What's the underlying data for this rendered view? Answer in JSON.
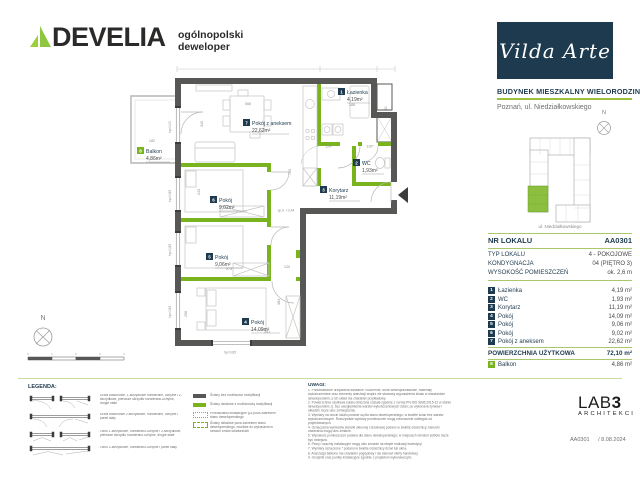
{
  "header": {
    "brand": "DEVELIA",
    "tagline_line1": "ogólnopolski",
    "tagline_line2": "deweloper",
    "project_name": "Vilda Arte",
    "building_type": "BUDYNEK MIESZKALNY WIELORODZINNY",
    "address": "Poznań, ul. Niedziałkowskiego",
    "north_label": "N"
  },
  "site_plan": {
    "street_caption": "ul. Niedziałkowskiego"
  },
  "unit": {
    "number_label": "NR LOKALU",
    "number": "AA0301",
    "type_label": "TYP LOKALU",
    "type": "4 - POKOJOWE",
    "floor_label": "KONDYGNACJA",
    "floor": "04 (PIĘTRO 3)",
    "height_label": "WYSOKOŚĆ POMIESZCZEŃ",
    "height": "ok. 2,6 m",
    "rooms": [
      {
        "num": "1",
        "name": "Łazienka",
        "area": "4,19 m²"
      },
      {
        "num": "2",
        "name": "WC",
        "area": "1,93 m²"
      },
      {
        "num": "3",
        "name": "Korytarz",
        "area": "11,19 m²"
      },
      {
        "num": "4",
        "name": "Pokój",
        "area": "14,09 m²"
      },
      {
        "num": "5",
        "name": "Pokój",
        "area": "9,06 m²"
      },
      {
        "num": "6",
        "name": "Pokój",
        "area": "9,02 m²"
      },
      {
        "num": "7",
        "name": "Pokój z aneksem",
        "area": "22,62 m²"
      }
    ],
    "total_label": "POWIERZCHNIA UŻYTKOWA",
    "total": "72,10 m²",
    "balcony": {
      "num": "8",
      "name": "Balkon",
      "area": "4,86 m²"
    }
  },
  "plan": {
    "labels": [
      {
        "num": "1",
        "name": "Łazienka",
        "area": "4,19m²"
      },
      {
        "num": "2",
        "name": "WC",
        "area": "1,93m²"
      },
      {
        "num": "3",
        "name": "Korytarz",
        "area": "11,19m²"
      },
      {
        "num": "4",
        "name": "Pokój",
        "area": "14,09m²"
      },
      {
        "num": "5",
        "name": "Pokój",
        "area": "9,06m²"
      },
      {
        "num": "6",
        "name": "Pokój",
        "area": "9,02m²"
      },
      {
        "num": "7",
        "name": "Pokój z aneksem",
        "area": "22,62m²"
      },
      {
        "num": "8",
        "name": "Balkon",
        "area": "4,86m²"
      }
    ],
    "dims": [
      "566",
      "340",
      "182",
      "188",
      "124*",
      "110*",
      "763",
      "243",
      "373",
      "120",
      "256",
      "383",
      "391",
      "sp.b. +2,44",
      "hp=0,00",
      "hp=0,85",
      "hp=0,85",
      "hp=0,85",
      "hp=0,85",
      "60"
    ],
    "scale_ticks": [
      "0",
      "1",
      "2",
      "3",
      "4"
    ],
    "north_label": "N"
  },
  "legend": {
    "title": "LEGENDA:",
    "windows": [
      "Drzwi balkonowe, 1-skrzydłowe rozwierane, uchylne i 2-skrzydłowe, pierwsze skrzydło rozwierano-uchylne, drugie stałe",
      "Drzwi balkonowe 2-skrzydłowe, rozwierane, uchylne i panel stały",
      "Okno 1-skrzydłowe, rozwierano-uchylne i 2-skrzydłowe, pierwsze skrzydło rozwierano-uchylne, drugie stałe",
      "Okno 2-skrzydłowe, rozwierano-uchylne i panel stały"
    ],
    "walls": [
      "Ściany bez możliwości modyfikacji",
      "Ściany działowe z możliwością modyfikacji",
      "Przedścianki instalacyjne g-k poza zakresem stanu deweloperskiego",
      "Ściany działowe poza zakresem stanu deweloperskiego, możliwe do wykonania w ramach zmian lokatorskich"
    ]
  },
  "uwagi": {
    "title": "UWAGI:",
    "notes": [
      "1. Przedstawione urządzenia sanitarne i kuchenne, drzwi wewnątrzlokalowe, materiały wykończeniowe oraz elementy aranżacji wnętrz nie stanowią wyposażenia lokalu w standardzie deweloperskim, a ich układ ma charakter przykładowy.",
      "2. Powierzchnia użytkowa lokalu obliczona została zgodnie z normą PN-ISO 9836:2015-12 w stanie deweloperskim, tj. bez uwzględnienia warstw wykończeniowych ścian; po wykonaniu tynków i okładzin może ulec zmniejszeniu.",
      "3. Wymiary na rzucie lokalu podane są dla stanu deweloperskiego, w świetle ścian bez warstw wykończeniowych. Rzeczywiste wymiary pomieszczeń mogą nieznacznie odbiegać od projektowanych.",
      "4. Oznaczenia wymiarów stolarki okiennej i drzwiowej podano w świetle ościeżnicy; kierunki otwierania mogą ulec zmianie.",
      "5. Wysokość pomieszczeń podana dla stanu deweloperskiego; w miejscach obniżeń sufitów może być mniejsza.",
      "6. Piony i szachty instalacyjne mogą ulec zmianie na etapie realizacji inwestycji.",
      "7. Wymiary oznaczone * podano w świetle ościeżnicy drzwi lub okna.",
      "8. Aranżacja balkonu ma charakter poglądowy i nie stanowi oferty handlowej.",
      "9. Grzejniki oraz punkty instalacyjne zgodnie z projektem wykonawczym."
    ]
  },
  "footer": {
    "architect_line1_a": "LAB",
    "architect_line1_b": "3",
    "architect_line2": "ARCHITEKCI",
    "doc_ref": "AA0301",
    "doc_date": "/ 8.08.2024"
  },
  "colors": {
    "navy": "#1d3a4e",
    "wall_dark": "#575756",
    "wall_green": "#79b41e",
    "accent_green": "#9cc23c"
  }
}
